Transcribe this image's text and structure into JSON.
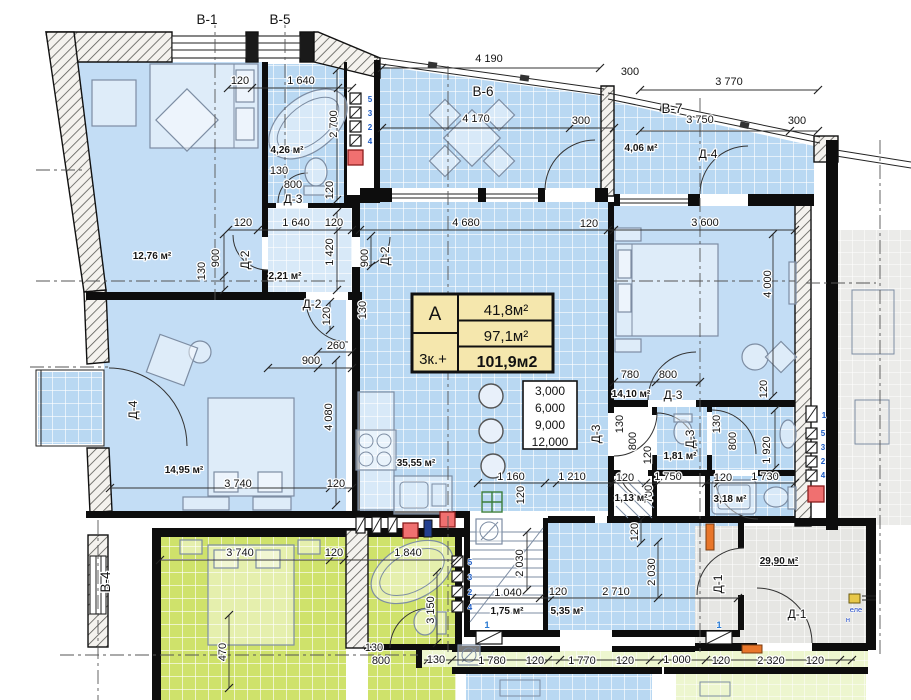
{
  "plan": {
    "title_block": {
      "type_label": "А",
      "rooms_label": "3к.+",
      "area_living": "41,8м²",
      "area_apartment": "97,1м²",
      "area_total": "101,9м2"
    },
    "elevation_marks": [
      "3,000",
      "6,000",
      "9,000",
      "12,000"
    ],
    "colors": {
      "room_blue": "#c3ddf5",
      "tile_blue": "#b9d8f2",
      "tile_green": "#cfe26b",
      "tile_gray": "#e6e6e3",
      "strip_green": "#edf6cf",
      "accent_red": "#f07070",
      "accent_orange": "#e8762a",
      "marker_blue": "#1f5fc4",
      "title_fill": "#f5e7ad"
    }
  },
  "labels": [
    {
      "n": "axis-label-b1",
      "t": "В-1",
      "x": 207,
      "y": 24,
      "cls": "axis"
    },
    {
      "n": "axis-label-b5",
      "t": "В-5",
      "x": 280,
      "y": 24,
      "cls": "axis"
    },
    {
      "n": "axis-label-b6",
      "t": "В-6",
      "x": 483,
      "y": 96,
      "cls": "axis"
    },
    {
      "n": "axis-label-b7",
      "t": "В-7",
      "x": 672,
      "y": 113,
      "cls": "axis"
    },
    {
      "n": "axis-label-b4",
      "t": "В-4",
      "x": 110,
      "y": 582,
      "r": -90,
      "cls": "axis"
    },
    {
      "t": "4 190",
      "x": 489,
      "y": 62
    },
    {
      "t": "300",
      "x": 630,
      "y": 75
    },
    {
      "t": "3 770",
      "x": 729,
      "y": 85
    },
    {
      "t": "4 170",
      "x": 476,
      "y": 122
    },
    {
      "t": "300",
      "x": 581,
      "y": 124
    },
    {
      "t": "3 750",
      "x": 700,
      "y": 123
    },
    {
      "t": "300",
      "x": 797,
      "y": 124
    },
    {
      "n": "area-balcony-b7",
      "t": "4,06 м²",
      "x": 641,
      "y": 151,
      "cls": "area"
    },
    {
      "n": "door-label-d4-balcony",
      "t": "Д-4",
      "x": 708,
      "y": 158,
      "cls": "door"
    },
    {
      "t": "120",
      "x": 240,
      "y": 84
    },
    {
      "t": "1 640",
      "x": 301,
      "y": 84
    },
    {
      "t": "2 700",
      "x": 337,
      "y": 124,
      "r": -90
    },
    {
      "n": "area-bath-top",
      "t": "4,26 м²",
      "x": 287,
      "y": 153,
      "cls": "area"
    },
    {
      "t": "130",
      "x": 279,
      "y": 174
    },
    {
      "t": "800",
      "x": 293,
      "y": 188
    },
    {
      "n": "door-label-d3-top",
      "t": "Д-3",
      "x": 293,
      "y": 203,
      "cls": "door"
    },
    {
      "t": "120",
      "x": 333,
      "y": 190,
      "r": -90
    },
    {
      "n": "area-bedroom-1",
      "t": "12,76 м²",
      "x": 152,
      "y": 259,
      "cls": "area"
    },
    {
      "t": "120",
      "x": 243,
      "y": 226
    },
    {
      "t": "1 640",
      "x": 296,
      "y": 226
    },
    {
      "t": "120",
      "x": 334,
      "y": 226
    },
    {
      "t": "900",
      "x": 219,
      "y": 258,
      "r": -90
    },
    {
      "t": "130",
      "x": 205,
      "y": 271,
      "r": -90
    },
    {
      "t": "1 420",
      "x": 333,
      "y": 252,
      "r": -90
    },
    {
      "n": "area-hall-top",
      "t": "2,21 м²",
      "x": 285,
      "y": 279,
      "cls": "area"
    },
    {
      "n": "door-label-d2-a",
      "t": "Д-2",
      "x": 249,
      "y": 260,
      "r": -90,
      "cls": "door"
    },
    {
      "n": "door-label-d2-b",
      "t": "Д-2",
      "x": 312,
      "y": 308,
      "cls": "door"
    },
    {
      "t": "120",
      "x": 330,
      "y": 316,
      "r": -90
    },
    {
      "t": "260",
      "x": 336,
      "y": 349
    },
    {
      "t": "900",
      "x": 311,
      "y": 364
    },
    {
      "t": "4 680",
      "x": 466,
      "y": 226
    },
    {
      "t": "120",
      "x": 589,
      "y": 227
    },
    {
      "t": "900",
      "x": 368,
      "y": 258,
      "r": -90
    },
    {
      "n": "door-label-d2-c",
      "t": "Д-2",
      "x": 389,
      "y": 256,
      "r": -90,
      "cls": "door"
    },
    {
      "t": "130",
      "x": 366,
      "y": 310,
      "r": -90
    },
    {
      "n": "area-kitchen-living",
      "t": "35,55 м²",
      "x": 416,
      "y": 466,
      "cls": "area"
    },
    {
      "t": "1 160",
      "x": 511,
      "y": 480
    },
    {
      "t": "1 210",
      "x": 572,
      "y": 480
    },
    {
      "t": "120",
      "x": 524,
      "y": 495,
      "r": -90
    },
    {
      "t": "3 600",
      "x": 705,
      "y": 226
    },
    {
      "t": "4 000",
      "x": 771,
      "y": 284,
      "r": -90
    },
    {
      "t": "780",
      "x": 630,
      "y": 378
    },
    {
      "t": "800",
      "x": 668,
      "y": 378
    },
    {
      "n": "area-bedroom-3",
      "t": "14,10 м²",
      "x": 631,
      "y": 397,
      "cls": "area"
    },
    {
      "n": "door-label-d3-bedroom",
      "t": "Д-3",
      "x": 673,
      "y": 399,
      "cls": "door"
    },
    {
      "t": "120",
      "x": 767,
      "y": 389,
      "r": -90
    },
    {
      "n": "door-label-d3-kitchen",
      "t": "Д-3",
      "x": 600,
      "y": 434,
      "r": -90,
      "cls": "door"
    },
    {
      "t": "130",
      "x": 623,
      "y": 424,
      "r": -90
    },
    {
      "t": "800",
      "x": 636,
      "y": 441,
      "r": -90
    },
    {
      "t": "120",
      "x": 651,
      "y": 455,
      "r": -90
    },
    {
      "n": "door-label-d3-wc",
      "t": "Д-3",
      "x": 694,
      "y": 439,
      "r": -90,
      "cls": "door"
    },
    {
      "t": "130",
      "x": 720,
      "y": 424,
      "r": -90
    },
    {
      "t": "800",
      "x": 736,
      "y": 441,
      "r": -90
    },
    {
      "t": "1 920",
      "x": 770,
      "y": 450,
      "r": -90
    },
    {
      "n": "area-wc-1",
      "t": "1,81 м²",
      "x": 680,
      "y": 459,
      "cls": "area"
    },
    {
      "t": "120",
      "x": 625,
      "y": 481
    },
    {
      "t": "1 750",
      "x": 668,
      "y": 480
    },
    {
      "t": "120",
      "x": 723,
      "y": 481
    },
    {
      "t": "1 730",
      "x": 765,
      "y": 480
    },
    {
      "t": "700",
      "x": 652,
      "y": 494,
      "r": -90
    },
    {
      "n": "area-wc-2",
      "t": "1,13 м²",
      "x": 631,
      "y": 501,
      "cls": "area"
    },
    {
      "n": "area-bath-right",
      "t": "3,18 м²",
      "x": 730,
      "y": 502,
      "cls": "area"
    },
    {
      "n": "area-bedroom-2",
      "t": "14,95 м²",
      "x": 184,
      "y": 473,
      "cls": "area"
    },
    {
      "t": "4 080",
      "x": 332,
      "y": 417,
      "r": -90
    },
    {
      "t": "3 740",
      "x": 238,
      "y": 487
    },
    {
      "t": "120",
      "x": 336,
      "y": 487
    },
    {
      "n": "door-label-d4-left",
      "t": "Д-4",
      "x": 137,
      "y": 410,
      "r": -90,
      "cls": "door"
    },
    {
      "t": "3 740",
      "x": 240,
      "y": 556
    },
    {
      "t": "120",
      "x": 334,
      "y": 556
    },
    {
      "t": "1 840",
      "x": 408,
      "y": 556
    },
    {
      "t": "470",
      "x": 226,
      "y": 652,
      "r": -90
    },
    {
      "t": "3 150",
      "x": 434,
      "y": 610,
      "r": -90
    },
    {
      "t": "130",
      "x": 374,
      "y": 651
    },
    {
      "t": "800",
      "x": 381,
      "y": 664
    },
    {
      "t": "2 030",
      "x": 523,
      "y": 563,
      "r": -90
    },
    {
      "t": "120",
      "x": 638,
      "y": 532,
      "r": -90
    },
    {
      "t": "2 030",
      "x": 655,
      "y": 572,
      "r": -90
    },
    {
      "t": "1 040",
      "x": 508,
      "y": 596
    },
    {
      "t": "120",
      "x": 558,
      "y": 595
    },
    {
      "t": "2 710",
      "x": 616,
      "y": 595
    },
    {
      "n": "area-stair",
      "t": "1,75 м²",
      "x": 507,
      "y": 614,
      "cls": "area"
    },
    {
      "n": "area-hall-bottom",
      "t": "5,35 м²",
      "x": 567,
      "y": 614,
      "cls": "area"
    },
    {
      "n": "area-corridor",
      "t": "29,90 м²",
      "x": 779,
      "y": 564,
      "cls": "area",
      "u": 1
    },
    {
      "n": "door-label-d1-a",
      "t": "Д-1",
      "x": 722,
      "y": 584,
      "r": -90,
      "cls": "door"
    },
    {
      "n": "door-label-d1-b",
      "t": "Д-1",
      "x": 797,
      "y": 618,
      "cls": "door"
    },
    {
      "n": "note-elevator",
      "t": "еле",
      "x": 856,
      "y": 612,
      "cls": "note"
    },
    {
      "n": "note-elevator-2",
      "t": "н",
      "x": 848,
      "y": 622,
      "cls": "note"
    },
    {
      "t": "130",
      "x": 436,
      "y": 663
    },
    {
      "t": "1 780",
      "x": 492,
      "y": 664
    },
    {
      "t": "120",
      "x": 535,
      "y": 664
    },
    {
      "t": "1 770",
      "x": 582,
      "y": 664
    },
    {
      "t": "120",
      "x": 625,
      "y": 664
    },
    {
      "t": "1 000",
      "x": 677,
      "y": 663
    },
    {
      "t": "120",
      "x": 721,
      "y": 664
    },
    {
      "t": "2 320",
      "x": 771,
      "y": 664
    },
    {
      "t": "120",
      "x": 815,
      "y": 664
    },
    {
      "n": "marker-1a",
      "t": "1",
      "x": 487,
      "y": 628,
      "cls": "marker"
    },
    {
      "n": "marker-1b",
      "t": "1",
      "x": 719,
      "y": 628,
      "cls": "marker"
    },
    {
      "n": "riser-num",
      "t": "5",
      "x": 370,
      "y": 102,
      "cls": "riser"
    },
    {
      "n": "riser-num",
      "t": "3",
      "x": 370,
      "y": 116,
      "cls": "riser"
    },
    {
      "n": "riser-num",
      "t": "2",
      "x": 370,
      "y": 130,
      "cls": "riser"
    },
    {
      "n": "riser-num",
      "t": "4",
      "x": 370,
      "y": 144,
      "cls": "riser"
    },
    {
      "n": "riser-num",
      "t": "5",
      "x": 470,
      "y": 565,
      "cls": "riser"
    },
    {
      "n": "riser-num",
      "t": "3",
      "x": 470,
      "y": 580,
      "cls": "riser"
    },
    {
      "n": "riser-num",
      "t": "2",
      "x": 470,
      "y": 595,
      "cls": "riser"
    },
    {
      "n": "riser-num",
      "t": "4",
      "x": 470,
      "y": 610,
      "cls": "riser"
    },
    {
      "n": "riser-num",
      "t": "1",
      "x": 824,
      "y": 418,
      "cls": "riser"
    },
    {
      "n": "riser-num",
      "t": "5",
      "x": 823,
      "y": 436,
      "cls": "riser"
    },
    {
      "n": "riser-num",
      "t": "3",
      "x": 823,
      "y": 450,
      "cls": "riser"
    },
    {
      "n": "riser-num",
      "t": "2",
      "x": 823,
      "y": 464,
      "cls": "riser"
    },
    {
      "n": "riser-num",
      "t": "4",
      "x": 823,
      "y": 478,
      "cls": "riser"
    }
  ]
}
